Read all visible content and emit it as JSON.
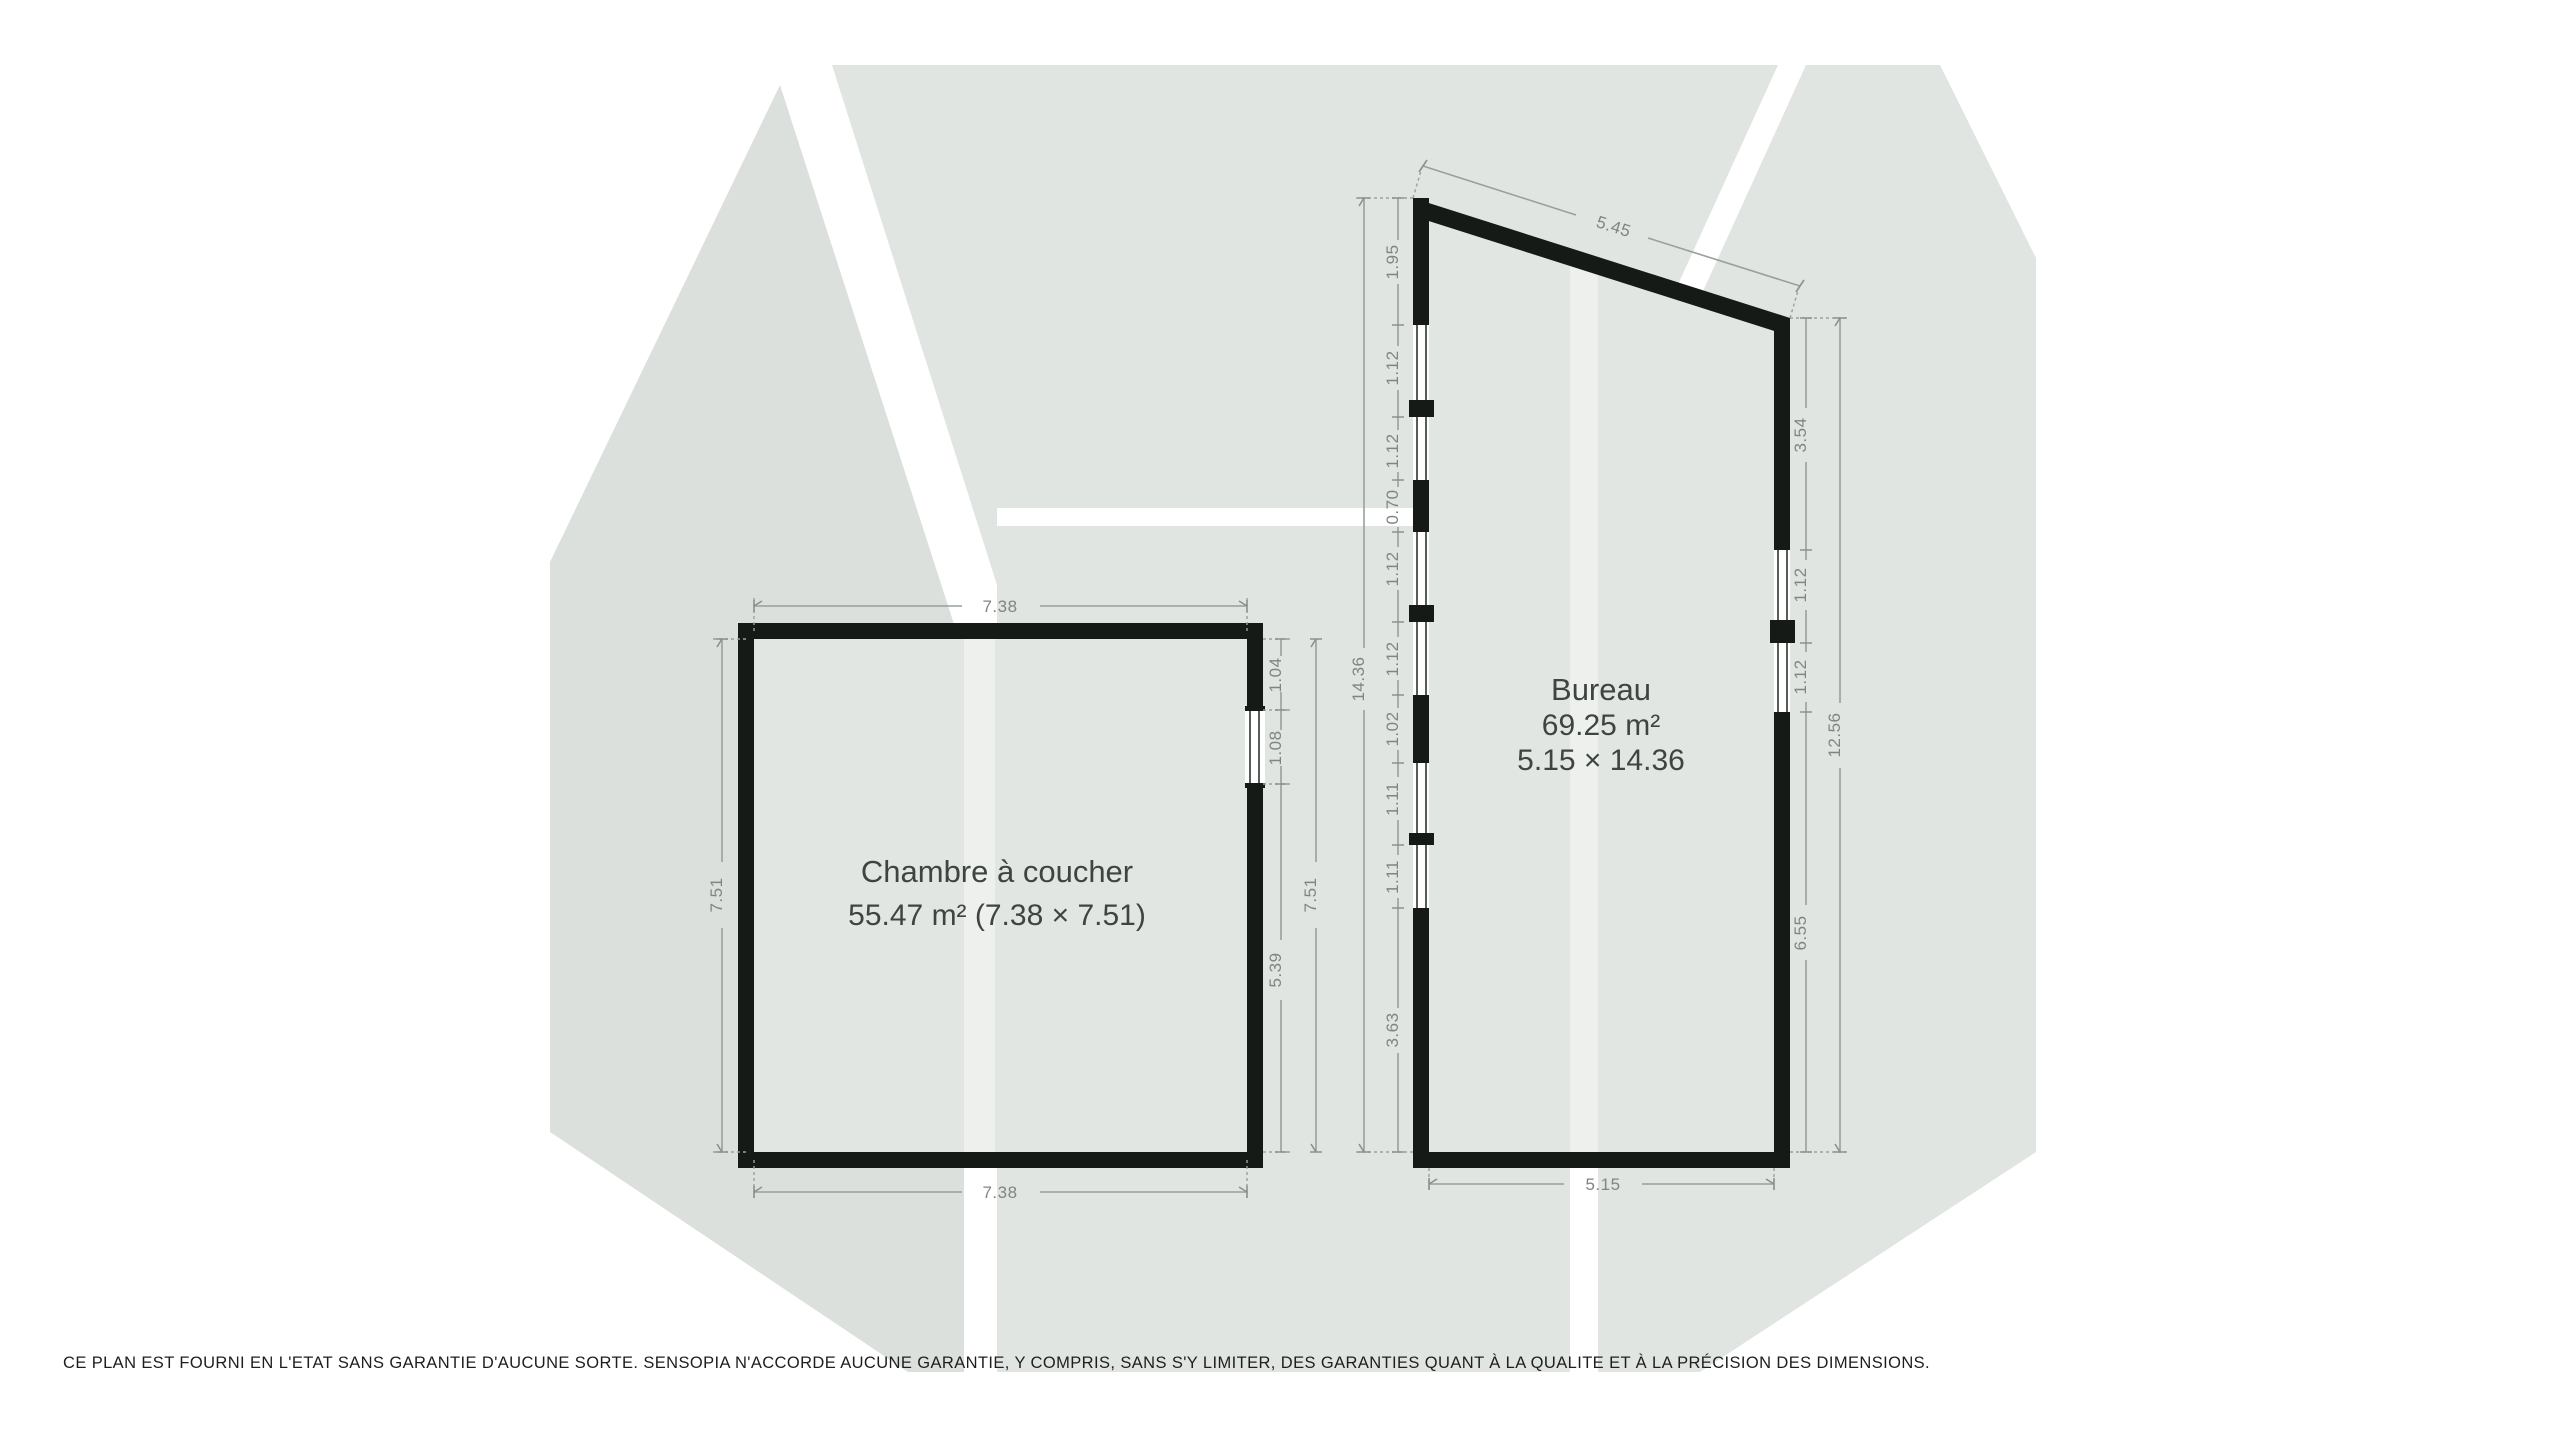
{
  "plan_title": "Floor plan",
  "colors": {
    "page_bg": "#ffffff",
    "watermark_left": "#dce0dd",
    "watermark_right": "#e0e5e1",
    "room_fill": "#e2e6e2",
    "room_fill_stripe": "#edf0ec",
    "wall": "#151a16",
    "dim_line": "#98a09a",
    "dim_text": "#7f857f",
    "room_label_text": "#3e4541",
    "disclaimer_text": "#1e1e1e"
  },
  "rooms": {
    "bedroom": {
      "name": "Chambre à coucher",
      "area_line": "55.47 m² (7.38 × 7.51)",
      "dims": {
        "top": "7.38",
        "bottom": "7.38",
        "left_total": "7.51",
        "right_total": "7.51",
        "right_segments": [
          "1.04",
          "1.08",
          "5.39"
        ]
      }
    },
    "office": {
      "name": "Bureau",
      "area_line": "69.25 m²",
      "size_line": "5.15 × 14.36",
      "dims": {
        "top_slanted": "5.45",
        "bottom": "5.15",
        "left_total": "14.36",
        "left_segments": [
          "1.95",
          "1.12",
          "1.12",
          "0.70",
          "1.12",
          "1.12",
          "1.02",
          "1.11",
          "1.11",
          "3.63"
        ],
        "right_total": "12.56",
        "right_segments": [
          "3.54",
          "1.12",
          "1.12",
          "6.55"
        ]
      }
    }
  },
  "disclaimer": "CE PLAN EST FOURNI EN L'ETAT SANS GARANTIE D'AUCUNE SORTE. SENSOPIA N'ACCORDE AUCUNE GARANTIE, Y COMPRIS, SANS S'Y LIMITER, DES GARANTIES QUANT À LA QUALITE ET À LA PRÉCISION DES DIMENSIONS."
}
